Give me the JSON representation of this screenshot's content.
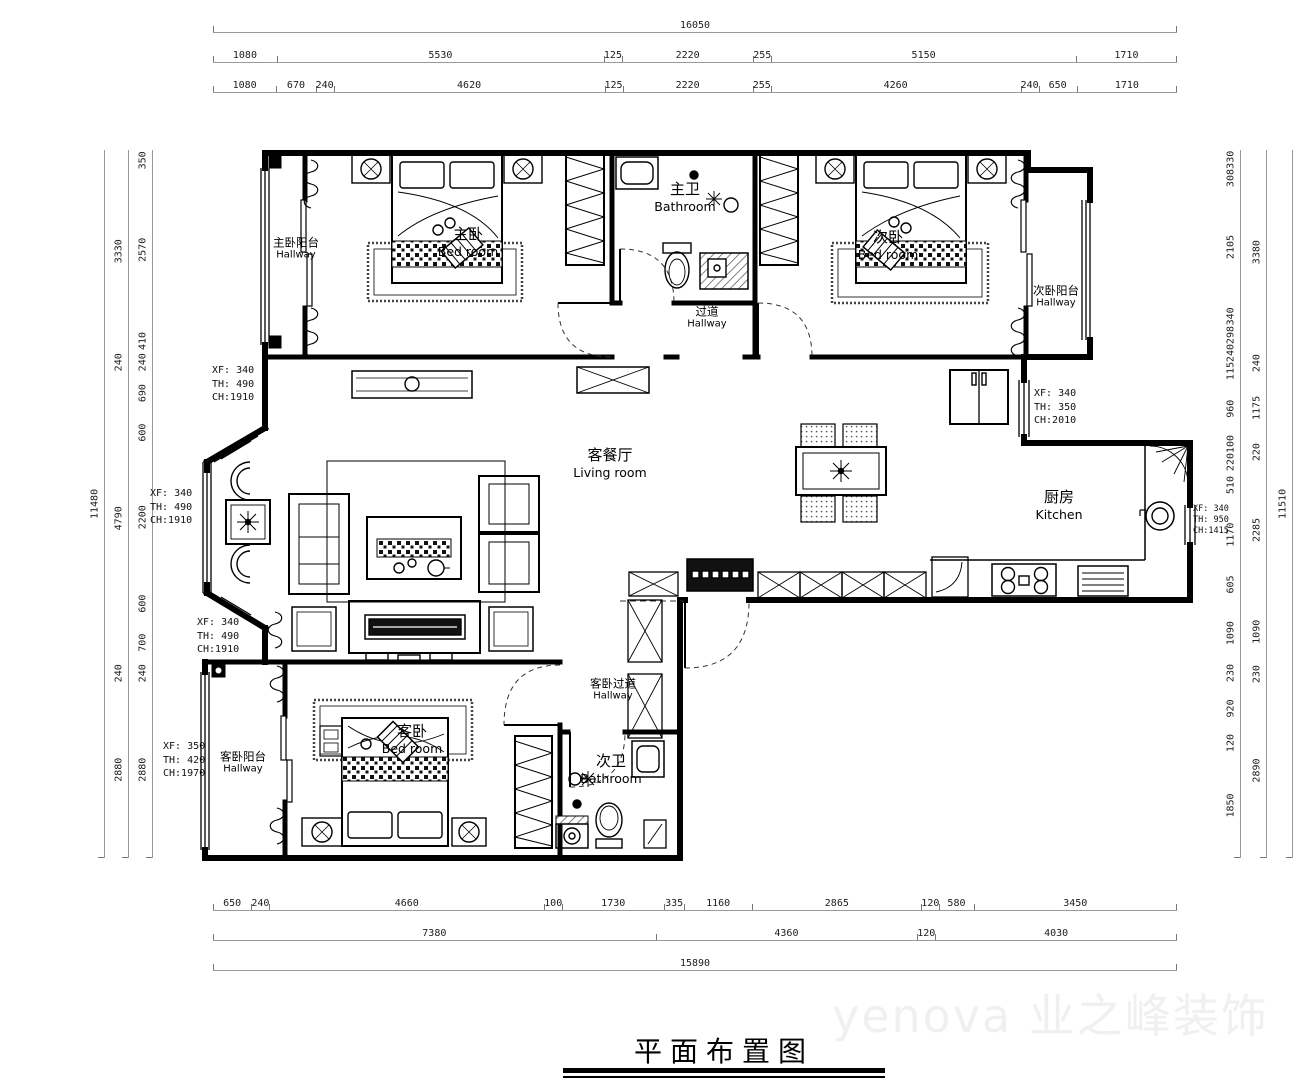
{
  "title": "平面布置图",
  "watermark": "yenova 业之峰装饰",
  "rooms": {
    "master_balcony": {
      "cn": "主卧阳台",
      "en": "Hallway"
    },
    "master_bedroom": {
      "cn": "主卧",
      "en": "Bed room"
    },
    "master_bath": {
      "cn": "主卫",
      "en": "Bathroom"
    },
    "hallway": {
      "cn": "过道",
      "en": "Hallway"
    },
    "second_bedroom": {
      "cn": "次卧",
      "en": "Bed room"
    },
    "second_balcony": {
      "cn": "次卧阳台",
      "en": "Hallway"
    },
    "living": {
      "cn": "客餐厅",
      "en": "Living room"
    },
    "kitchen": {
      "cn": "厨房",
      "en": "Kitchen"
    },
    "guest_bedroom": {
      "cn": "客卧",
      "en": "Bed room"
    },
    "guest_balcony": {
      "cn": "客卧阳台",
      "en": "Hallway"
    },
    "guest_hall": {
      "cn": "客卧过道",
      "en": "Hallway"
    },
    "second_bath": {
      "cn": "次卫",
      "en": "Bathroom"
    }
  },
  "window_tags": {
    "w1": [
      "XF: 340",
      "TH: 490",
      "CH:1910"
    ],
    "w2": [
      "XF: 340",
      "TH: 490",
      "CH:1910"
    ],
    "w3": [
      "XF: 340",
      "TH: 490",
      "CH:1910"
    ],
    "w4": [
      "XF: 350",
      "TH: 420",
      "CH:1970"
    ],
    "w5": [
      "XF: 340",
      "TH: 350",
      "CH:2010"
    ],
    "w6": [
      "XF: 340",
      "TH: 950",
      "CH:1415"
    ]
  },
  "dims": {
    "top_total": [
      "16050"
    ],
    "top_mid": [
      "1080",
      "5530",
      "125",
      "2220",
      "255",
      "5150",
      "1710"
    ],
    "top_inner": [
      "1080",
      "670",
      "240",
      "4620",
      "125",
      "2220",
      "255",
      "4260",
      "240",
      "650",
      "1710"
    ],
    "bottom_inner": [
      "650",
      "240",
      "4660",
      "100",
      "1730",
      "335",
      "1160",
      "2865",
      "120",
      "580",
      "3450"
    ],
    "bottom_mid": [
      "7380",
      "4360",
      "120",
      "4030"
    ],
    "bottom_total": [
      "15890"
    ],
    "left_total": [
      "11480"
    ],
    "left_mid": [
      "3330",
      "240",
      "4790",
      "240",
      "2880"
    ],
    "left_inner": [
      "350",
      "2570",
      "410",
      "240",
      "690",
      "600",
      "2200",
      "600",
      "700",
      "240",
      "2880"
    ],
    "right_inner": [
      "330",
      "308",
      "2105",
      "340",
      "298",
      "240",
      "115",
      "960",
      "100",
      "220",
      "510",
      "1170",
      "605",
      "1090",
      "230",
      "920",
      "120",
      "1850"
    ],
    "right_mid": [
      "3380",
      "240",
      "1175",
      "220",
      "2285",
      "1090",
      "230",
      "2890"
    ],
    "right_total": [
      "11510"
    ]
  }
}
